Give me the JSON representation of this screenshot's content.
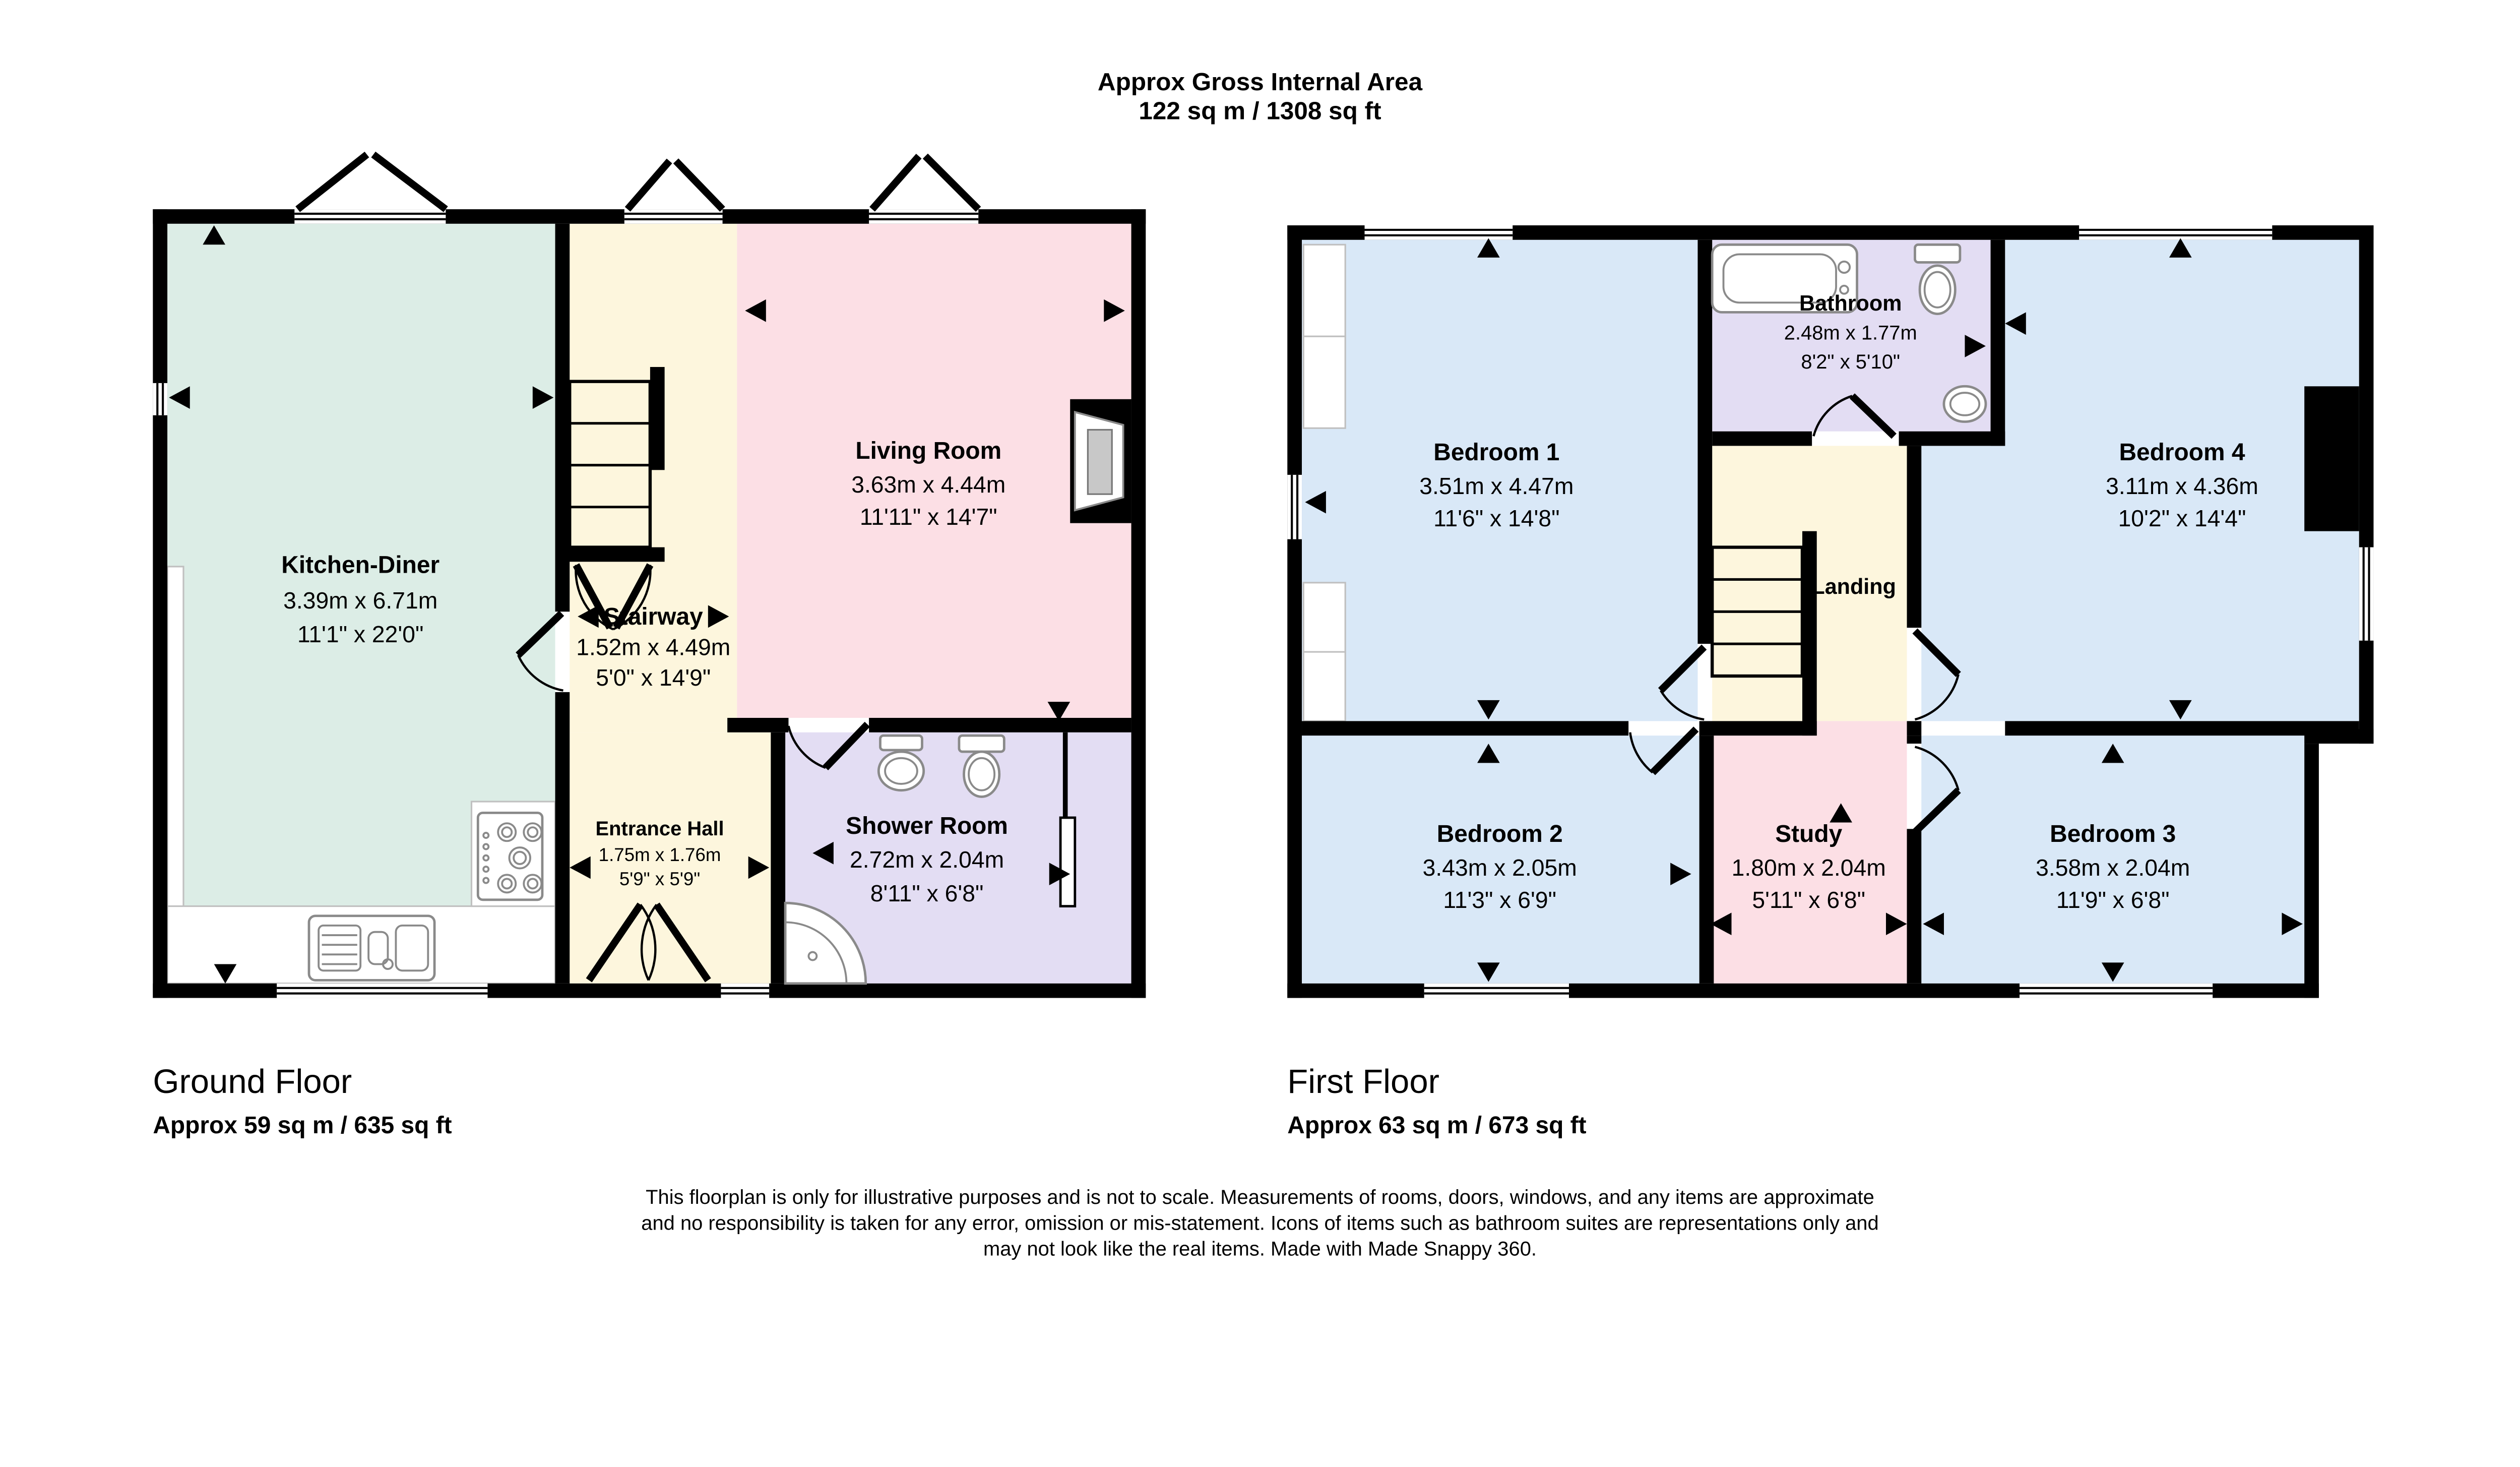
{
  "title": {
    "line1": "Approx Gross Internal Area",
    "line2": "122 sq m / 1308 sq ft"
  },
  "ground_floor": {
    "caption": "Ground Floor",
    "area": "Approx 59 sq m / 635 sq ft",
    "rooms": [
      {
        "name": "Kitchen-Diner",
        "metric": "3.39m x 6.71m",
        "imperial": "11'1\" x 22'0\""
      },
      {
        "name": "Stairway",
        "metric": "1.52m x 4.49m",
        "imperial": "5'0\" x 14'9\""
      },
      {
        "name": "Living Room",
        "metric": "3.63m x 4.44m",
        "imperial": "11'11\" x 14'7\""
      },
      {
        "name": "Entrance Hall",
        "metric": "1.75m x 1.76m",
        "imperial": "5'9\" x 5'9\""
      },
      {
        "name": "Shower Room",
        "metric": "2.72m x 2.04m",
        "imperial": "8'11\" x 6'8\""
      }
    ]
  },
  "first_floor": {
    "caption": "First Floor",
    "area": "Approx 63 sq m / 673 sq ft",
    "rooms": [
      {
        "name": "Bedroom 1",
        "metric": "3.51m x 4.47m",
        "imperial": "11'6\" x 14'8\""
      },
      {
        "name": "Bathroom",
        "metric": "2.48m x 1.77m",
        "imperial": "8'2\" x 5'10\""
      },
      {
        "name": "Bedroom 4",
        "metric": "3.11m x 4.36m",
        "imperial": "10'2\" x 14'4\""
      },
      {
        "name": "Landing"
      },
      {
        "name": "Bedroom 2",
        "metric": "3.43m x 2.05m",
        "imperial": "11'3\" x 6'9\""
      },
      {
        "name": "Study",
        "metric": "1.80m x 2.04m",
        "imperial": "5'11\" x 6'8\""
      },
      {
        "name": "Bedroom 3",
        "metric": "3.58m x 2.04m",
        "imperial": "11'9\" x 6'8\""
      }
    ]
  },
  "footer": {
    "disclaimer_line1": "This floorplan is only for illustrative purposes and is not to scale. Measurements of rooms, doors, windows, and any items are approximate",
    "disclaimer_line2": "and no responsibility is taken for any error, omission or mis-statement. Icons of items such as bathroom suites are representations only and",
    "disclaimer_line3": "may not look like the real items. Made with Made Snappy 360."
  },
  "colors": {
    "kitchen": "#dcede6",
    "hall_stairs": "#fdf6dd",
    "living_study": "#fcdfe5",
    "bathrooms": "#e3ddf3",
    "bedrooms": "#d9e8f7",
    "walls": "#000000"
  }
}
